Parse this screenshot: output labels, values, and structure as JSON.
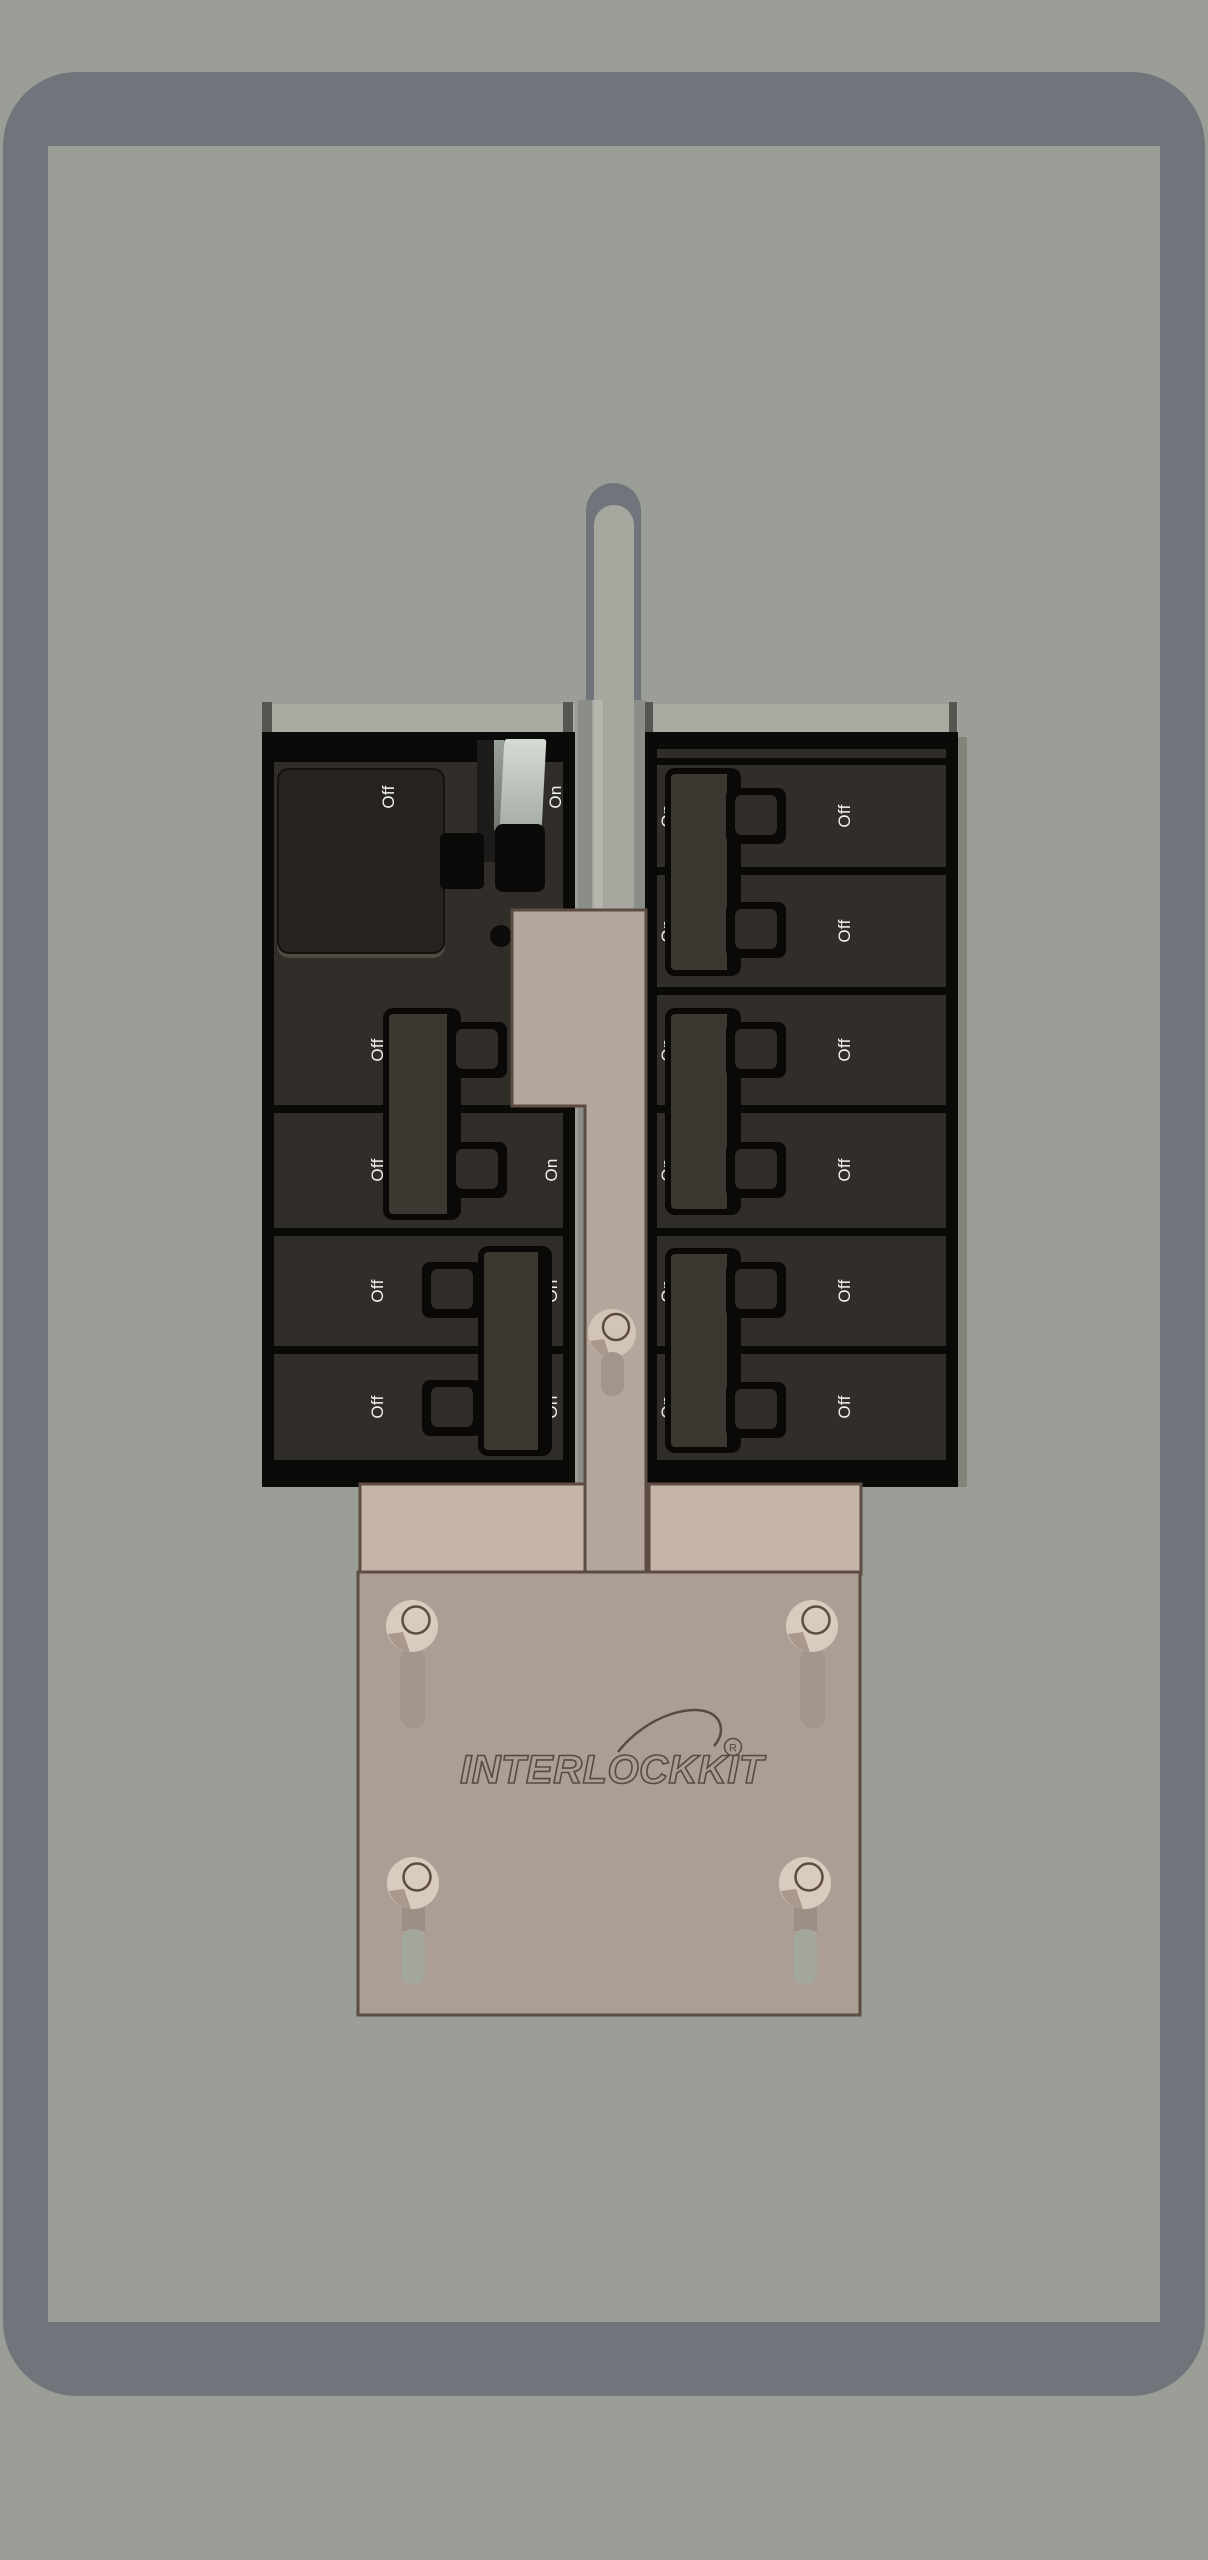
{
  "brand": {
    "name": "INTERLOCKKIT",
    "registered_mark": "R"
  },
  "left_panel": {
    "main_breaker": {
      "off_label": "Off",
      "on_label": "On"
    },
    "breakers": [
      {
        "off_label": "Off",
        "on_label": "On"
      },
      {
        "off_label": "Off",
        "on_label": "On"
      },
      {
        "off_label": "Off",
        "on_label": "On"
      },
      {
        "off_label": "Off",
        "on_label": "On"
      }
    ]
  },
  "right_panel": {
    "breakers": [
      {
        "on_label": "On",
        "off_label": "Off"
      },
      {
        "on_label": "On",
        "off_label": "Off"
      },
      {
        "on_label": "On",
        "off_label": "Off"
      },
      {
        "on_label": "On",
        "off_label": "Off"
      },
      {
        "on_label": "On",
        "off_label": "Off"
      },
      {
        "on_label": "On",
        "off_label": "Off"
      }
    ]
  },
  "colors": {
    "background": "#9b9e96",
    "door_frame": "#6f757a",
    "breaker_body": "#312e29",
    "label_text": "#f2f2ef",
    "interlock_slide": "#b4a69a",
    "interlock_wing": "#c5b5a9",
    "interlock_plate": "#ab9e94",
    "interlock_outline": "#5c4c42",
    "brand_outline": "#5a4a40"
  }
}
